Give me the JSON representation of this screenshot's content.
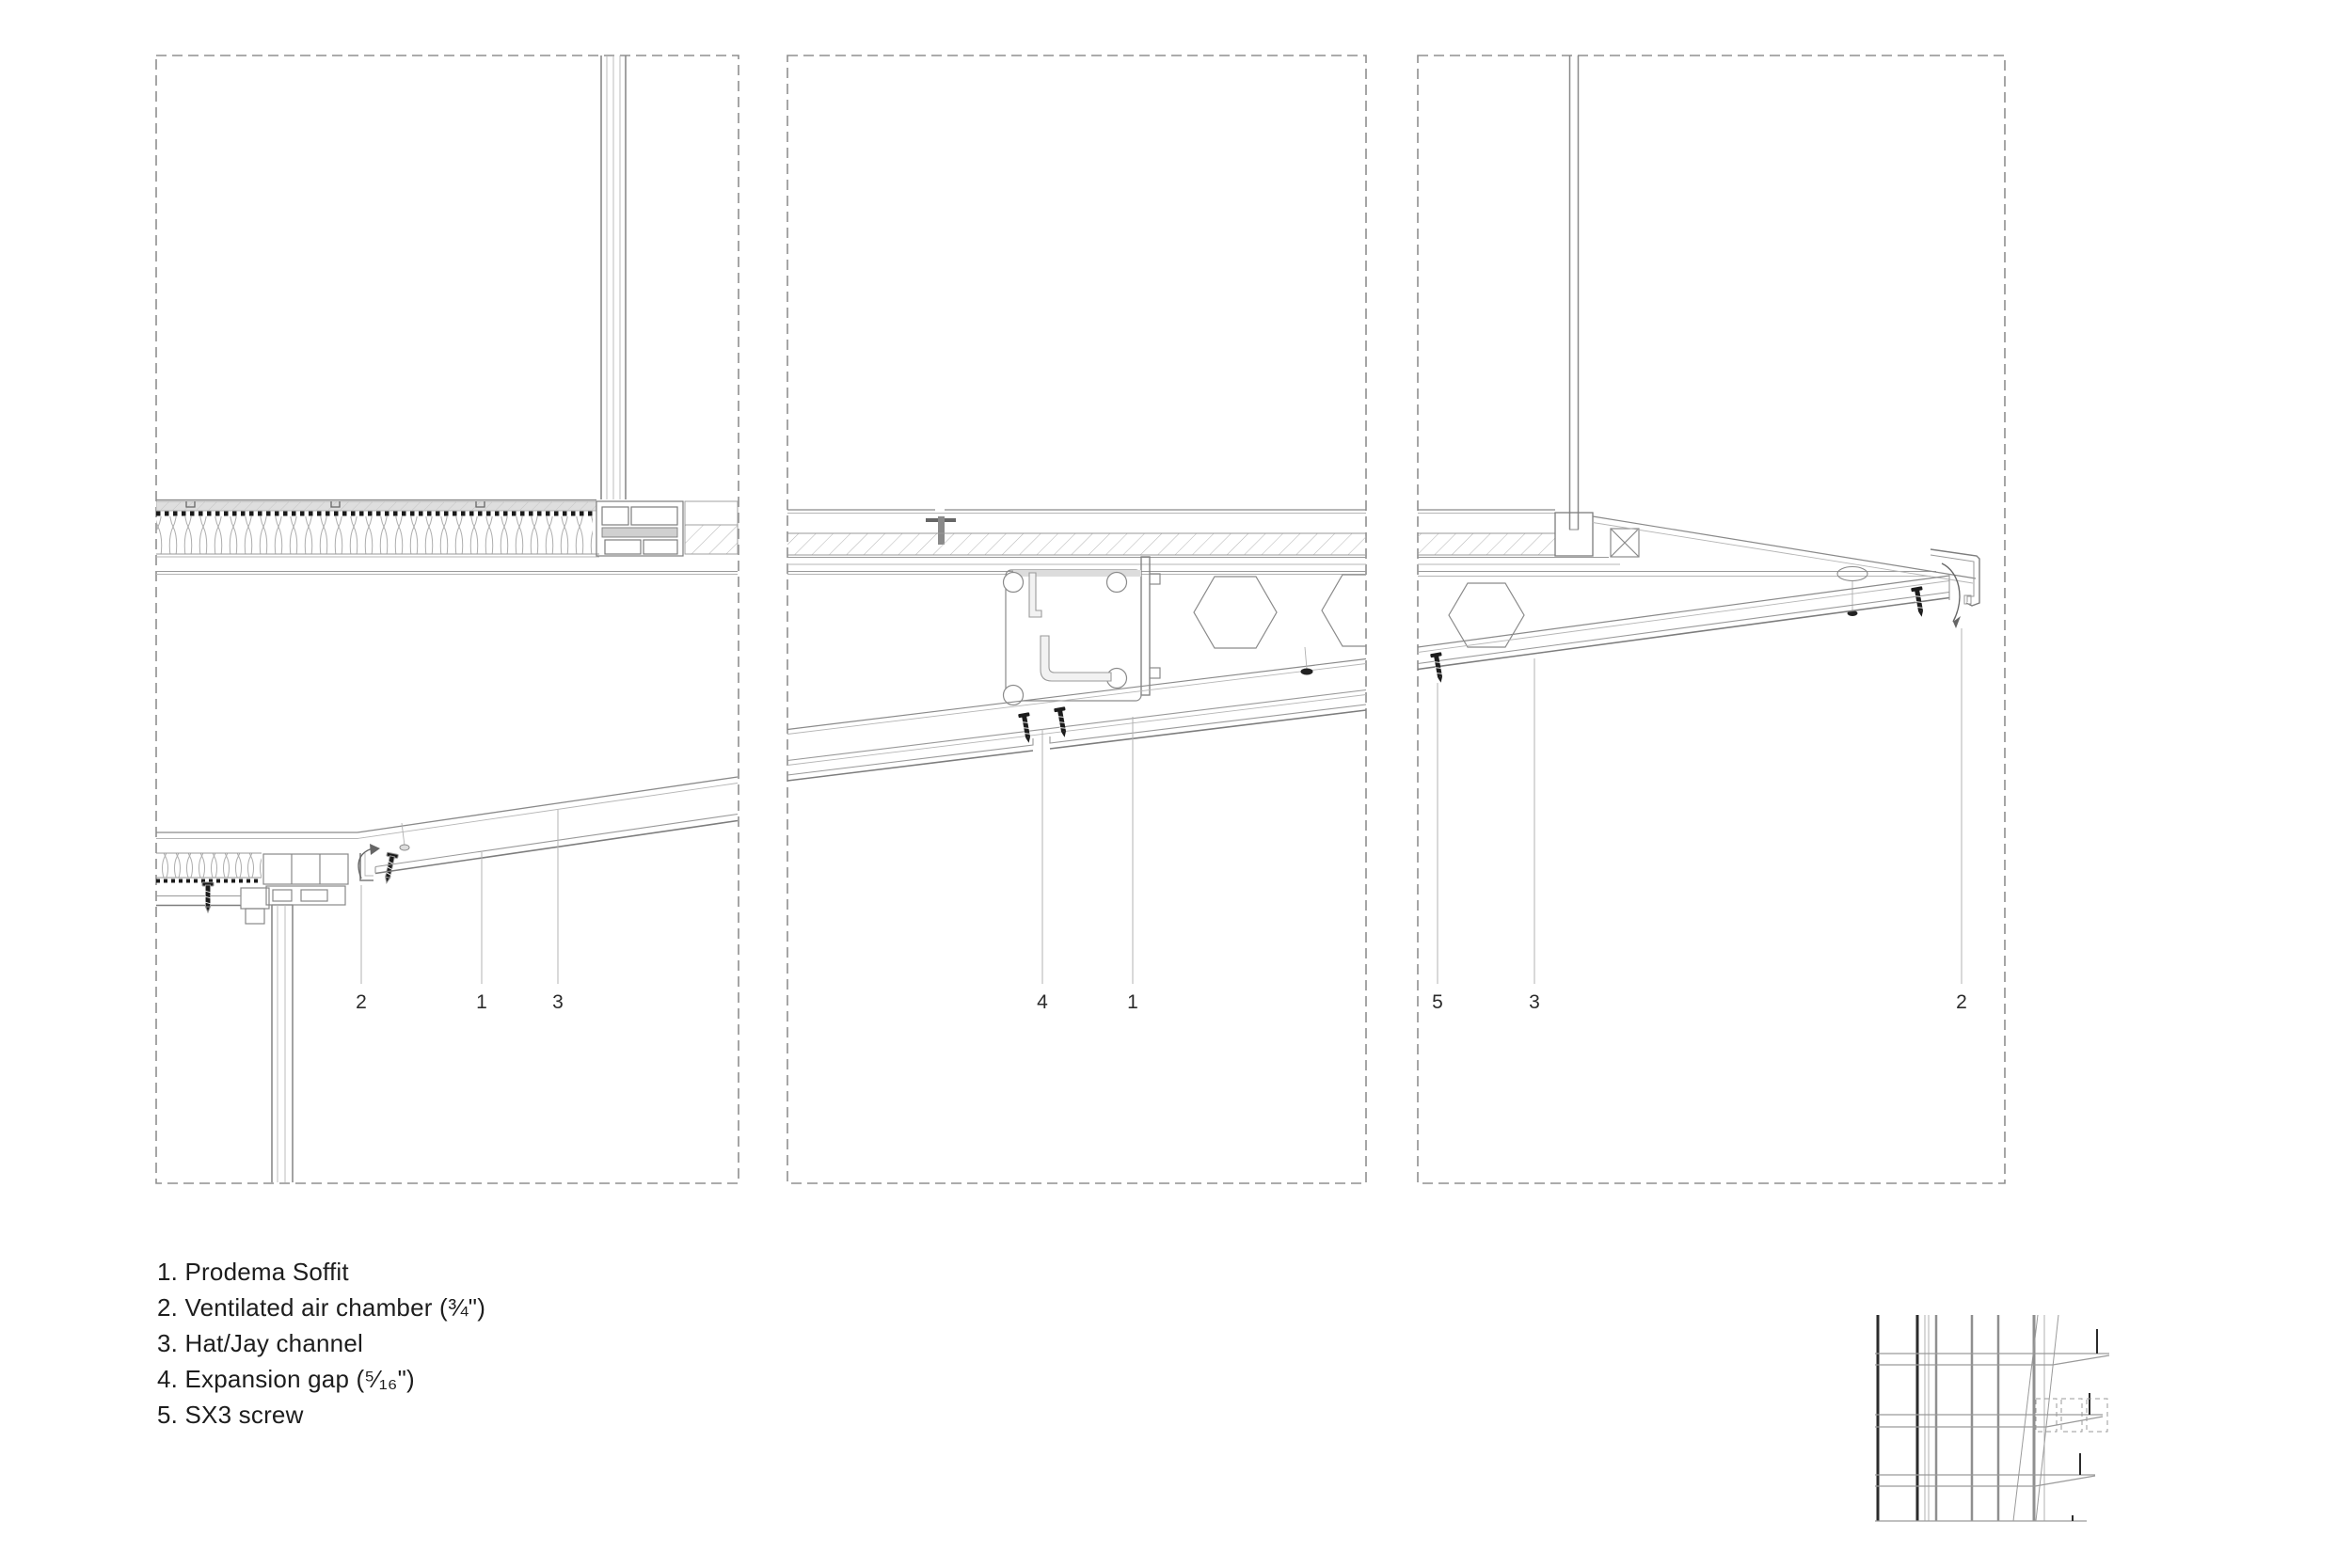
{
  "drawing_title": "Prodema soffit construction detail sections",
  "colors": {
    "background": "#ffffff",
    "line_light": "#b5b5b5",
    "line_mid": "#999999",
    "line_dark": "#777777",
    "ink": "#1d1d1d",
    "screw_black": "#1c1c1c",
    "screed_fill": "#dedede"
  },
  "panels": [
    {
      "callouts": [
        "2",
        "1",
        "3"
      ]
    },
    {
      "callouts": [
        "4",
        "1"
      ]
    },
    {
      "callouts": [
        "5",
        "3",
        "2"
      ]
    }
  ],
  "legend": {
    "items": [
      "1. Prodema Soffit",
      "2. Ventilated air chamber (¾\")",
      "3. Hat/Jay channel",
      "4. Expansion gap (⁵⁄₁₆\")",
      "5. SX3 screw"
    ]
  }
}
